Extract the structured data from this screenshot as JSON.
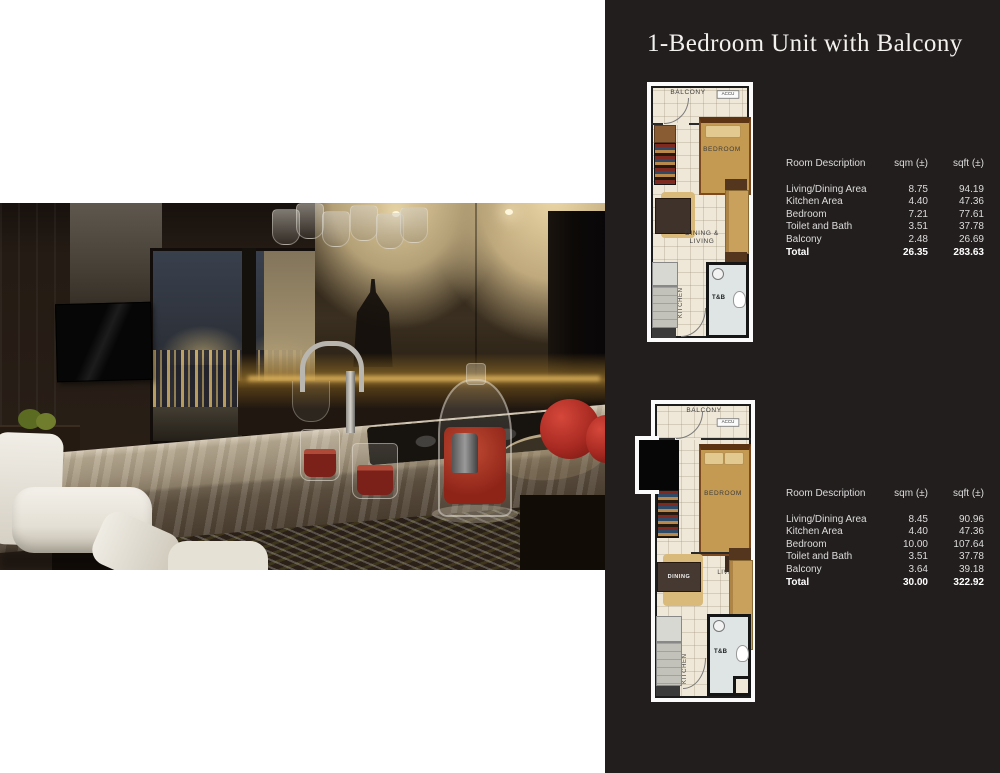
{
  "page_title": "1-Bedroom Unit with Balcony",
  "colors": {
    "panel_bg": "#221e1d",
    "plan_bg": "#efe8d8",
    "table_text": "#dcdcdc",
    "total_text": "#ffffff",
    "title_text": "#f2f1ee"
  },
  "unit_a": {
    "plan": {
      "balcony": "BALCONY",
      "accu": "ACCU",
      "bedroom": "BEDROOM",
      "dining_living_line1": "DINING &",
      "dining_living_line2": "LIVING",
      "kitchen": "KITCHEN",
      "toilet_bath": "T&B"
    },
    "table": {
      "header": {
        "room": "Room Description",
        "sqm": "sqm (±)",
        "sqft": "sqft (±)"
      },
      "rows": [
        {
          "room": "Living/Dining Area",
          "sqm": "8.75",
          "sqft": "94.19"
        },
        {
          "room": "Kitchen Area",
          "sqm": "4.40",
          "sqft": "47.36"
        },
        {
          "room": "Bedroom",
          "sqm": "7.21",
          "sqft": "77.61"
        },
        {
          "room": "Toilet and Bath",
          "sqm": "3.51",
          "sqft": "37.78"
        },
        {
          "room": "Balcony",
          "sqm": "2.48",
          "sqft": "26.69"
        }
      ],
      "total": {
        "room": "Total",
        "sqm": "26.35",
        "sqft": "283.63"
      }
    }
  },
  "unit_b": {
    "plan": {
      "balcony": "BALCONY",
      "accu": "ACCU",
      "bedroom": "BEDROOM",
      "dining": "DINING",
      "living": "LIVING",
      "kitchen": "KITCHEN",
      "toilet_bath": "T&B"
    },
    "table": {
      "header": {
        "room": "Room Description",
        "sqm": "sqm (±)",
        "sqft": "sqft (±)"
      },
      "rows": [
        {
          "room": "Living/Dining Area",
          "sqm": "8.45",
          "sqft": "90.96"
        },
        {
          "room": "Kitchen Area",
          "sqm": "4.40",
          "sqft": "47.36"
        },
        {
          "room": "Bedroom",
          "sqm": "10.00",
          "sqft": "107.64"
        },
        {
          "room": "Toilet and Bath",
          "sqm": "3.51",
          "sqft": "37.78"
        },
        {
          "room": "Balcony",
          "sqm": "3.64",
          "sqft": "39.18"
        }
      ],
      "total": {
        "room": "Total",
        "sqm": "30.00",
        "sqft": "322.92"
      }
    }
  }
}
